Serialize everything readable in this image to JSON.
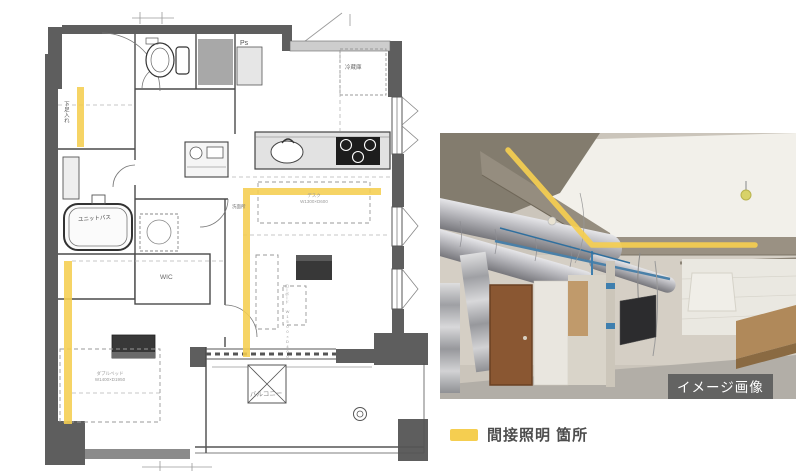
{
  "colors": {
    "highlight_yellow": "#F5CE50",
    "wall_dark": "#5E5E5E",
    "legend_text": "#4D4D4D"
  },
  "floor_plan": {
    "labels": {
      "shoe_storage": "下足入れ",
      "pipe_space": "Ps",
      "refrigerator": "冷蔵庫",
      "unit_bath": "ユニットバス",
      "washroom": "洗面所",
      "walk_in_closet": "WIC",
      "desk_line1": "デスク",
      "desk_line2": "W1300×D600",
      "tv_board": "ローボード W1500×D400",
      "double_bed_line1": "ダブルベッド",
      "double_bed_line2": "W1400×D1950",
      "balcony": "バルコニー"
    }
  },
  "photo": {
    "caption": "イメージ画像"
  },
  "legend": {
    "label": "間接照明 箇所"
  }
}
